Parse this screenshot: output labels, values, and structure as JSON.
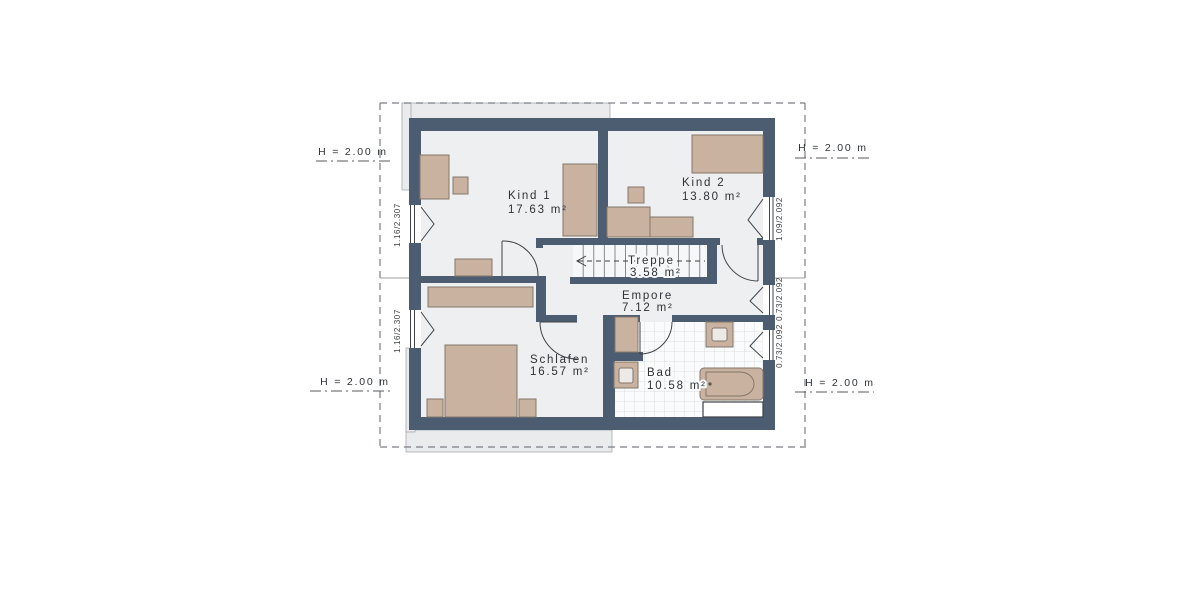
{
  "plan_title": "Dachgeschoss Grundriss",
  "colors": {
    "wall": "#4d5d71",
    "floor": "#edeff0",
    "furniture": "#c9b2a0",
    "tile_floor": "#fafbfc",
    "overhang_gray": "#e9ebec",
    "text": "#2e3236"
  },
  "rooms": {
    "kind1": {
      "name": "Kind 1",
      "area": "17.63 m²"
    },
    "kind2": {
      "name": "Kind 2",
      "area": "13.80 m²"
    },
    "treppe": {
      "name": "Treppe",
      "area": "3.58 m²"
    },
    "empore": {
      "name": "Empore",
      "area": "7.12 m²"
    },
    "schlafen": {
      "name": "Schlafen",
      "area": "16.57 m²"
    },
    "bad": {
      "name": "Bad",
      "area": "10.58 m²"
    }
  },
  "height_marker": {
    "label": "H = 2.00 m"
  },
  "window_dims": {
    "left_top": "1.16/2.307",
    "left_bottom": "1.16/2.307",
    "right_top": "1.09/2.092",
    "right_mid": "0.73/2.092",
    "right_bottom": "0.73/2.092"
  }
}
